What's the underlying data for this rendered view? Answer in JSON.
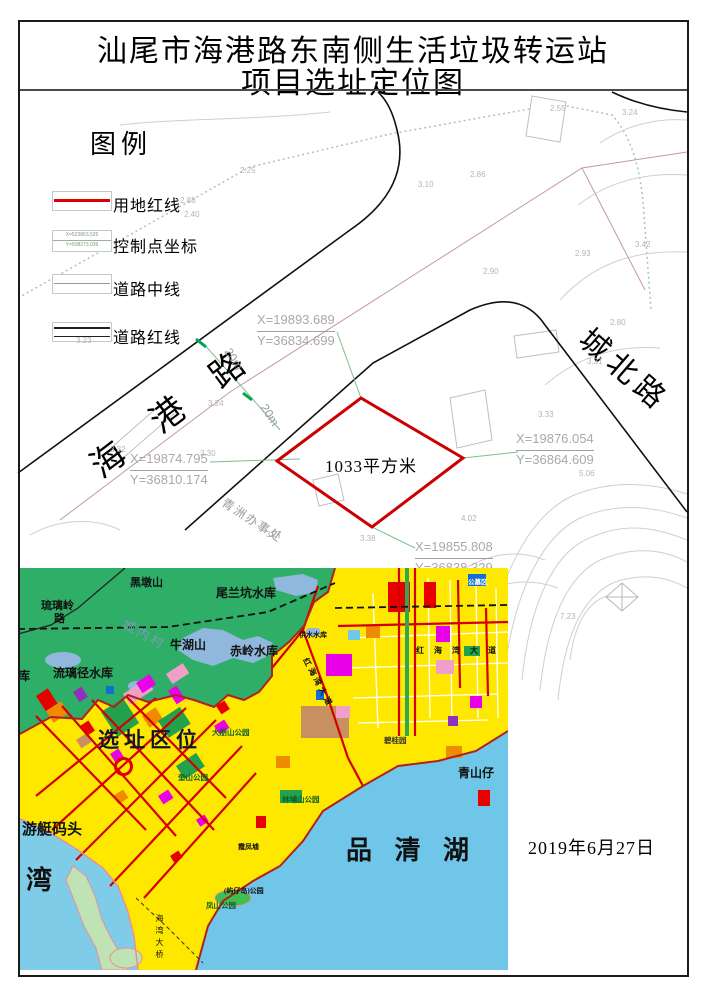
{
  "title": {
    "line1": "汕尾市海港路东南侧生活垃圾转运站",
    "line2": "项目选址定位图"
  },
  "legend": {
    "title": "图例",
    "items": [
      {
        "label": "用地红线"
      },
      {
        "label": "控制点坐标",
        "sample_x": "X=523863.525",
        "sample_y": "Y=508273.039"
      },
      {
        "label": "道路中线"
      },
      {
        "label": "道路红线"
      }
    ]
  },
  "cad": {
    "road_haigang": "海 港 路",
    "road_chengbei": "城北路",
    "district_office": "青洲办事处",
    "site_area_label": "1033平方米",
    "dim_labels": [
      "20m",
      "20m"
    ],
    "control_points": [
      {
        "x": "X=19893.689",
        "y": "Y=36834.699"
      },
      {
        "x": "X=19876.054",
        "y": "Y=36864.609"
      },
      {
        "x": "X=19874.795",
        "y": "Y=36810.174"
      },
      {
        "x": "X=19855.808",
        "y": "Y=36838.329"
      }
    ],
    "elevation_labels": [
      "3.10",
      "2.25",
      "2.55",
      "3.24",
      "2.88",
      "2.40",
      "2.86",
      "2.93",
      "3.42",
      "2.90",
      "2.80",
      "3.31",
      "3.33",
      "3.24",
      "3.32",
      "3.30",
      "5.06",
      "4.02",
      "3.27",
      "3.38",
      "7.23",
      "3.23"
    ]
  },
  "inset": {
    "labels": {
      "heidun_hill": "黑墩山",
      "weilankeng_reservoir": "尾兰坑水库",
      "liuliling_road_1": "琉璃岭",
      "liuliling_road_2": "路",
      "chengnei_village": "城内村",
      "niuhu_hill": "牛湖山",
      "chiling_reservoir": "赤岭水库",
      "gongshui_reservoir": "供水水库",
      "liulijing_reservoir": "流璃径水库",
      "reservoir_partial": "库",
      "site_location": "选址区位",
      "dapengshan_park": "大朋山公园",
      "bigui_garden": "碧桂园",
      "honghaiwan_avenue_h": "红 海 湾 大 道",
      "honghaiwan_avenue_d": "红海湾大道",
      "kuishan_park": "奎山公园",
      "linpushan_park": "林埔山公园",
      "yacht_wharf": "游艇码头",
      "bay": "湾",
      "pinqing_lake": "品 清 湖",
      "qingshanzai": "青山仔",
      "xiafeng_xu": "霞凤墟",
      "yuzaidao_park": "(屿仔岛)公园",
      "fengshan_park": "凤山公园",
      "haiwan_bridge": "海湾大桥",
      "cemetery_area": "公墓区"
    }
  },
  "date": "2019年6月27日",
  "colors": {
    "site_red_line": "#cc0000",
    "hill_green": "#2fae68",
    "lake_blue": "#6fc6e8",
    "reservoir_blue": "#8fb8dc",
    "urban_yellow": "#ffe800",
    "road_red": "#d40000"
  }
}
